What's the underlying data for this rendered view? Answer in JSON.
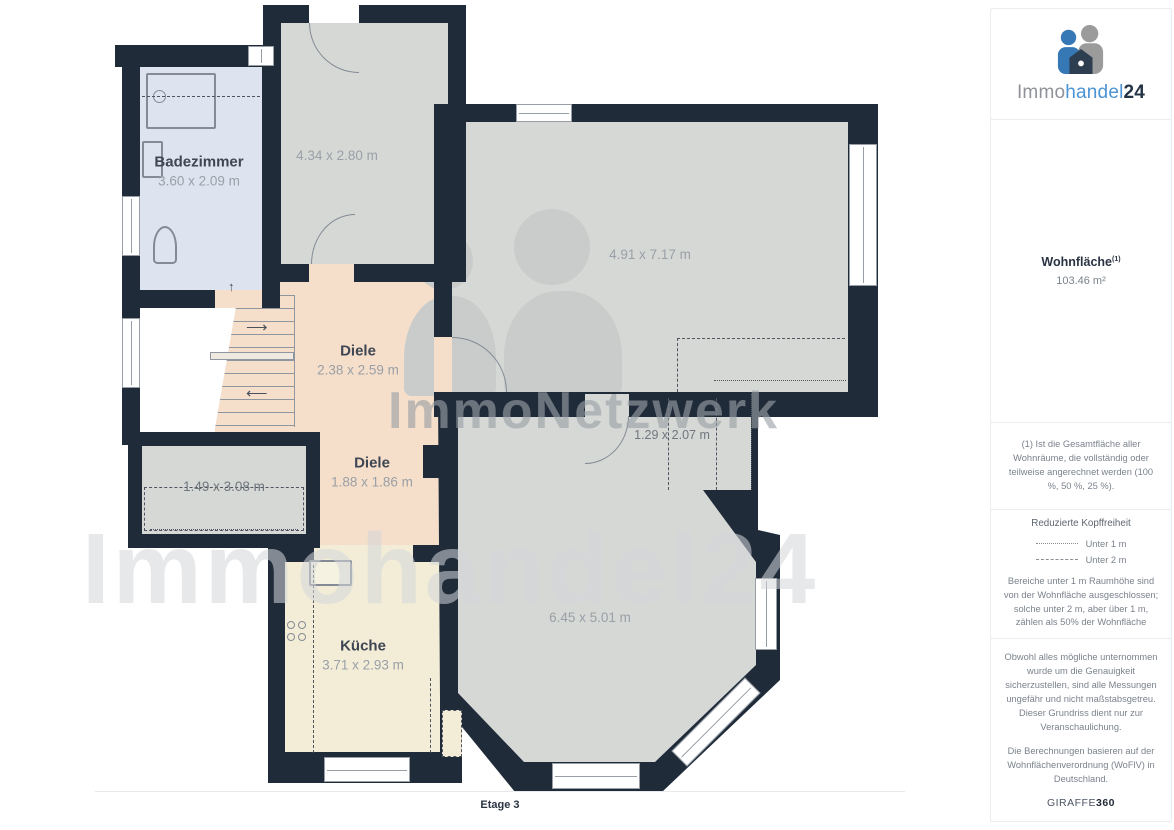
{
  "sidebar": {
    "brand": {
      "prefix": "Immo",
      "mid": "handel",
      "suffix": "24"
    },
    "area": {
      "title": "Wohnfläche",
      "sup": "(1)",
      "value": "103.46 m²"
    },
    "note": "(1) Ist die Gesamtfläche aller Wohnräume, die vollständig oder teilweise angerechnet werden (100 %, 50 %, 25 %).",
    "legend": {
      "title": "Reduzierte Kopffreiheit",
      "items": [
        {
          "label": "Unter 1 m"
        },
        {
          "label": "Unter 2 m"
        }
      ],
      "description": "Bereiche unter 1 m Raumhöhe sind von der Wohnfläche ausgeschlossen; solche unter 2 m, aber über 1 m, zählen als 50% der Wohnfläche"
    },
    "disclaimer_accuracy": "Obwohl alles mögliche unternommen wurde um die Genauigkeit sicherzustellen, sind alle Messungen ungefähr und nicht maßstabsgetreu. Dieser Grundriss dient nur zur Veranschaulichung.",
    "disclaimer_calc": "Die Berechnungen basieren auf der Wohnflächenverordnung (WoFlV) in Deutschland.",
    "provider": {
      "name": "GIRAFFE",
      "suffix": "360"
    }
  },
  "floorplan": {
    "floor_label": "Etage 3",
    "watermarks": {
      "center": "ImmoNetzwerk",
      "large": "Immohandel24"
    },
    "icons": {
      "stair_up": "↑",
      "stair_right": "⟶",
      "stair_left": "⟵"
    },
    "rooms": {
      "badezimmer": {
        "name": "Badezimmer",
        "dims": "3.60 x 2.09 m"
      },
      "room_top": {
        "dims": "4.34 x 2.80 m"
      },
      "room_large": {
        "dims": "4.91 x 7.17 m"
      },
      "diele_upper": {
        "name": "Diele",
        "dims": "2.38 x 2.59 m"
      },
      "diele_lower": {
        "name": "Diele",
        "dims": "1.88 x 1.86 m"
      },
      "storage": {
        "dims": "1.49 x 3.08 m"
      },
      "alcove": {
        "dims": "1.29 x 2.07 m"
      },
      "room_bottom": {
        "dims": "6.45 x 5.01 m"
      },
      "kueche": {
        "name": "Küche",
        "dims": "3.71 x 2.93 m"
      }
    },
    "colors": {
      "wall": "#202b3a",
      "room_gray": "#d6d8d6",
      "room_blue": "#dde4ef",
      "room_peach": "#f6dfca",
      "room_cream": "#f3edd8"
    }
  }
}
